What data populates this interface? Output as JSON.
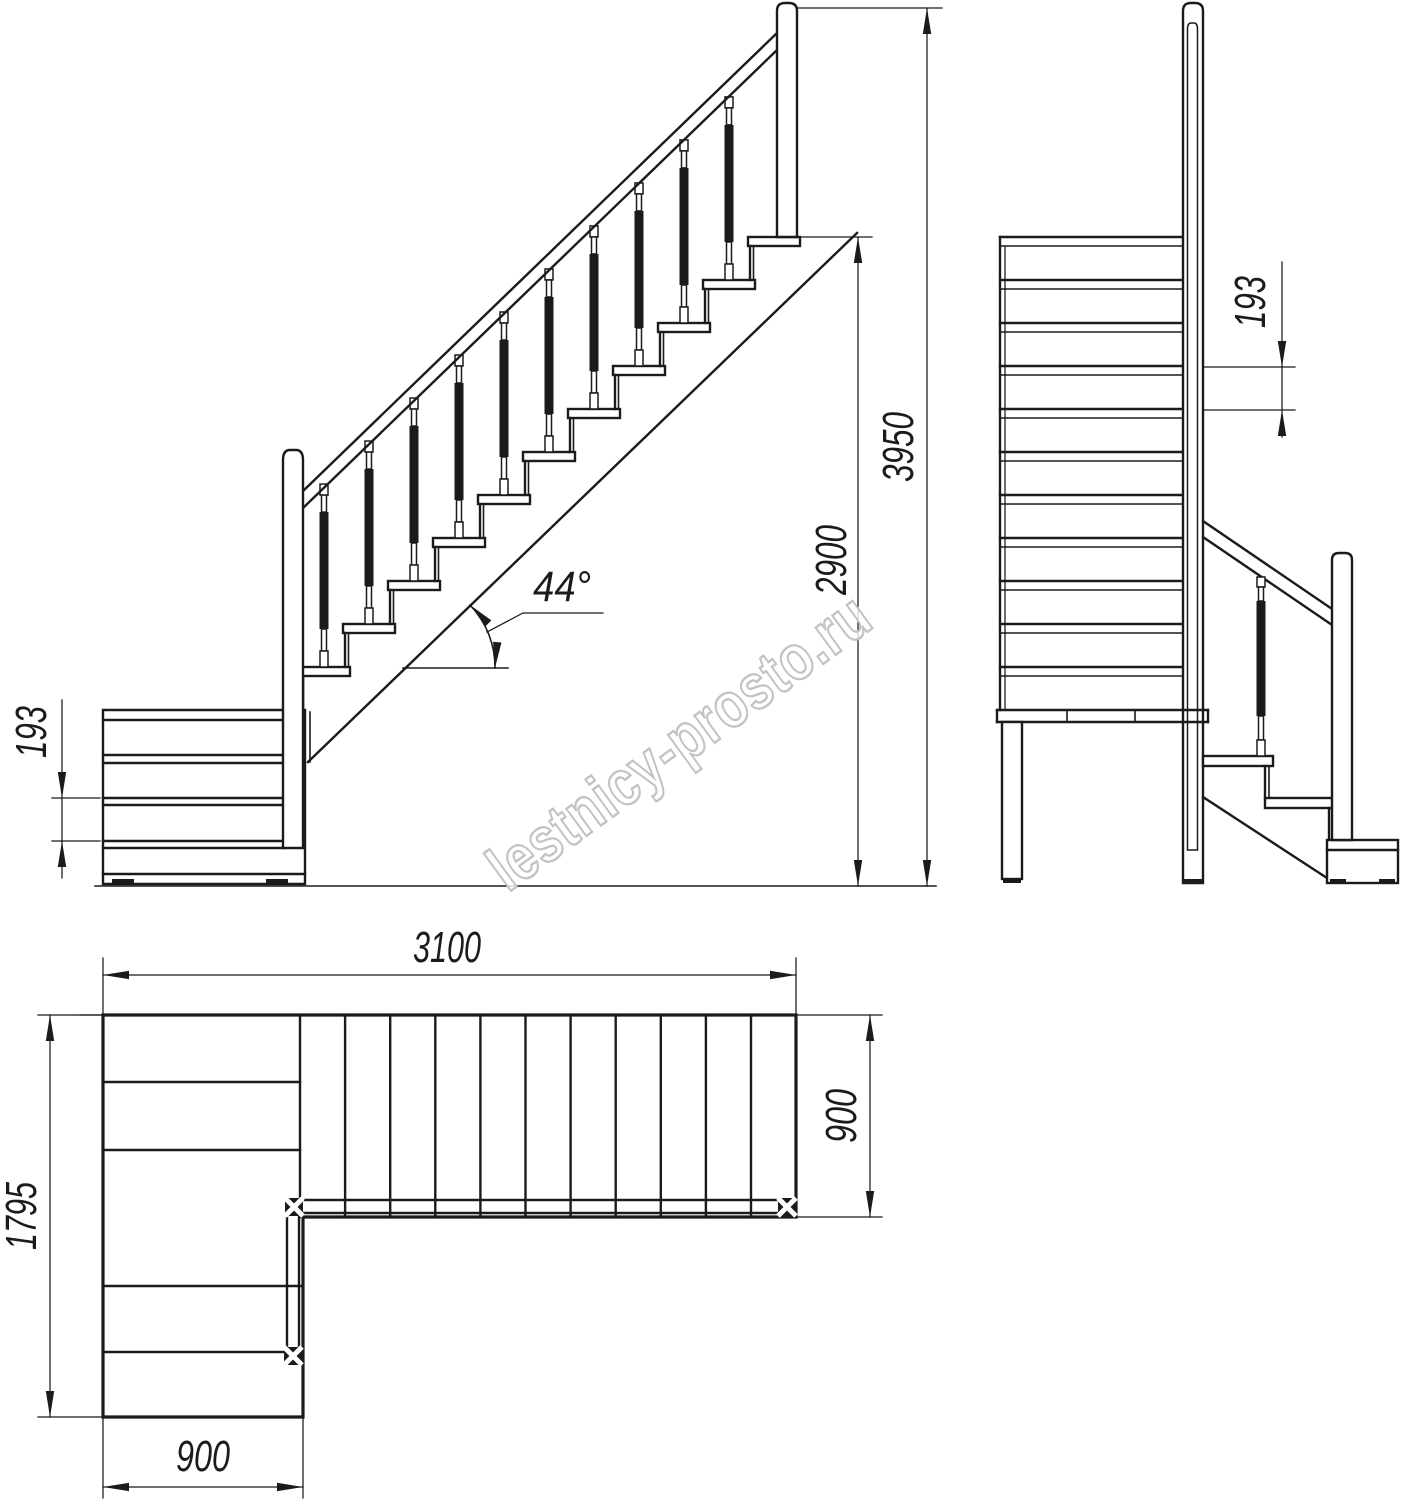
{
  "background": "#ffffff",
  "line_color": "#1b1b1b",
  "watermark": {
    "text": "lestnicy-prosto.ru",
    "color": "#c3c3c3"
  },
  "views": {
    "side": {
      "label": "side elevation of L-shaped staircase",
      "angle": "44°",
      "riser_height": "193",
      "flight_height": "2900",
      "total_height": "3950"
    },
    "front": {
      "label": "front elevation of staircase",
      "riser_height": "193"
    },
    "plan": {
      "label": "plan of staircase",
      "flight_length": "3100",
      "flight_width": "900",
      "total_depth": "1795",
      "lower_flight_width": "900"
    }
  }
}
